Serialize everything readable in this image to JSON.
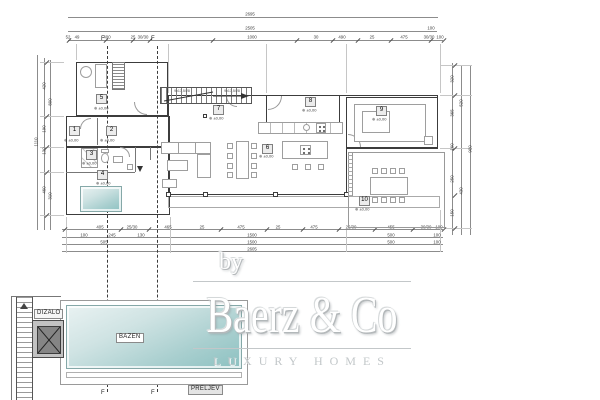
{
  "drawing": {
    "rooms": [
      "1",
      "2",
      "3",
      "4",
      "5",
      "6",
      "7",
      "8",
      "9",
      "10"
    ],
    "elevation_mark": "±0,00",
    "stair_note": "9x17,5/28",
    "pool_label": "BAZEN",
    "elevator_label": "DIZALO",
    "overflow_label": "PRELJEV",
    "section_marker": "F"
  },
  "watermark": {
    "prefix": "by",
    "brand": "Baerz & Co",
    "tagline": "LUXURY HOMES"
  },
  "colors": {
    "wall": "#3c3c3c",
    "dimension": "#3f3f3f",
    "pool_light": "#e9f2f2",
    "pool_dark": "#8cc1c1",
    "watermark_outline": "#c3c7c9"
  },
  "dim_labels": [
    {
      "x": 250,
      "y": 14,
      "t": "2695"
    },
    {
      "x": 250,
      "y": 28,
      "t": "2505"
    },
    {
      "x": 431,
      "y": 28,
      "t": "100"
    },
    {
      "x": 68,
      "y": 37,
      "t": "52"
    },
    {
      "x": 77,
      "y": 37,
      "t": "49"
    },
    {
      "x": 107,
      "y": 37,
      "t": "400"
    },
    {
      "x": 133,
      "y": 37,
      "t": "25"
    },
    {
      "x": 143,
      "y": 37,
      "t": "30/30"
    },
    {
      "x": 252,
      "y": 37,
      "t": "1000"
    },
    {
      "x": 316,
      "y": 37,
      "t": "30"
    },
    {
      "x": 342,
      "y": 37,
      "t": "490"
    },
    {
      "x": 372,
      "y": 37,
      "t": "25"
    },
    {
      "x": 404,
      "y": 37,
      "t": "475"
    },
    {
      "x": 429,
      "y": 37,
      "t": "30/30"
    },
    {
      "x": 440,
      "y": 37,
      "t": "100"
    },
    {
      "x": 100,
      "y": 227,
      "t": "405"
    },
    {
      "x": 132,
      "y": 227,
      "t": "25/30"
    },
    {
      "x": 168,
      "y": 227,
      "t": "465"
    },
    {
      "x": 202,
      "y": 227,
      "t": "25"
    },
    {
      "x": 241,
      "y": 227,
      "t": "475"
    },
    {
      "x": 278,
      "y": 227,
      "t": "25"
    },
    {
      "x": 314,
      "y": 227,
      "t": "475"
    },
    {
      "x": 351,
      "y": 227,
      "t": "25/30"
    },
    {
      "x": 391,
      "y": 227,
      "t": "455"
    },
    {
      "x": 426,
      "y": 227,
      "t": "30/30"
    },
    {
      "x": 439,
      "y": 227,
      "t": "100"
    },
    {
      "x": 84,
      "y": 235,
      "t": "100"
    },
    {
      "x": 112,
      "y": 235,
      "t": "245"
    },
    {
      "x": 141,
      "y": 235,
      "t": "130"
    },
    {
      "x": 252,
      "y": 235,
      "t": "1500"
    },
    {
      "x": 391,
      "y": 235,
      "t": "500"
    },
    {
      "x": 437,
      "y": 235,
      "t": "100"
    },
    {
      "x": 104,
      "y": 242,
      "t": "505"
    },
    {
      "x": 252,
      "y": 242,
      "t": "1500"
    },
    {
      "x": 391,
      "y": 242,
      "t": "500"
    },
    {
      "x": 437,
      "y": 242,
      "t": "100"
    },
    {
      "x": 252,
      "y": 249,
      "t": "2605"
    },
    {
      "x": 36,
      "y": 142,
      "t": "1110",
      "v": 1
    },
    {
      "x": 44,
      "y": 86,
      "t": "420",
      "v": 1
    },
    {
      "x": 44,
      "y": 129,
      "t": "190",
      "v": 1
    },
    {
      "x": 44,
      "y": 151,
      "t": "130",
      "v": 1
    },
    {
      "x": 44,
      "y": 190,
      "t": "460",
      "v": 1
    },
    {
      "x": 50,
      "y": 102,
      "t": "800",
      "v": 1
    },
    {
      "x": 50,
      "y": 196,
      "t": "310",
      "v": 1
    },
    {
      "x": 452,
      "y": 79,
      "t": "320",
      "v": 1
    },
    {
      "x": 452,
      "y": 113,
      "t": "365",
      "v": 1
    },
    {
      "x": 452,
      "y": 147,
      "t": "160",
      "v": 1
    },
    {
      "x": 452,
      "y": 179,
      "t": "250",
      "v": 1
    },
    {
      "x": 452,
      "y": 213,
      "t": "150",
      "v": 1
    },
    {
      "x": 461,
      "y": 103,
      "t": "520",
      "v": 1
    },
    {
      "x": 461,
      "y": 191,
      "t": "430",
      "v": 1
    },
    {
      "x": 470,
      "y": 149,
      "t": "900",
      "v": 1
    }
  ]
}
